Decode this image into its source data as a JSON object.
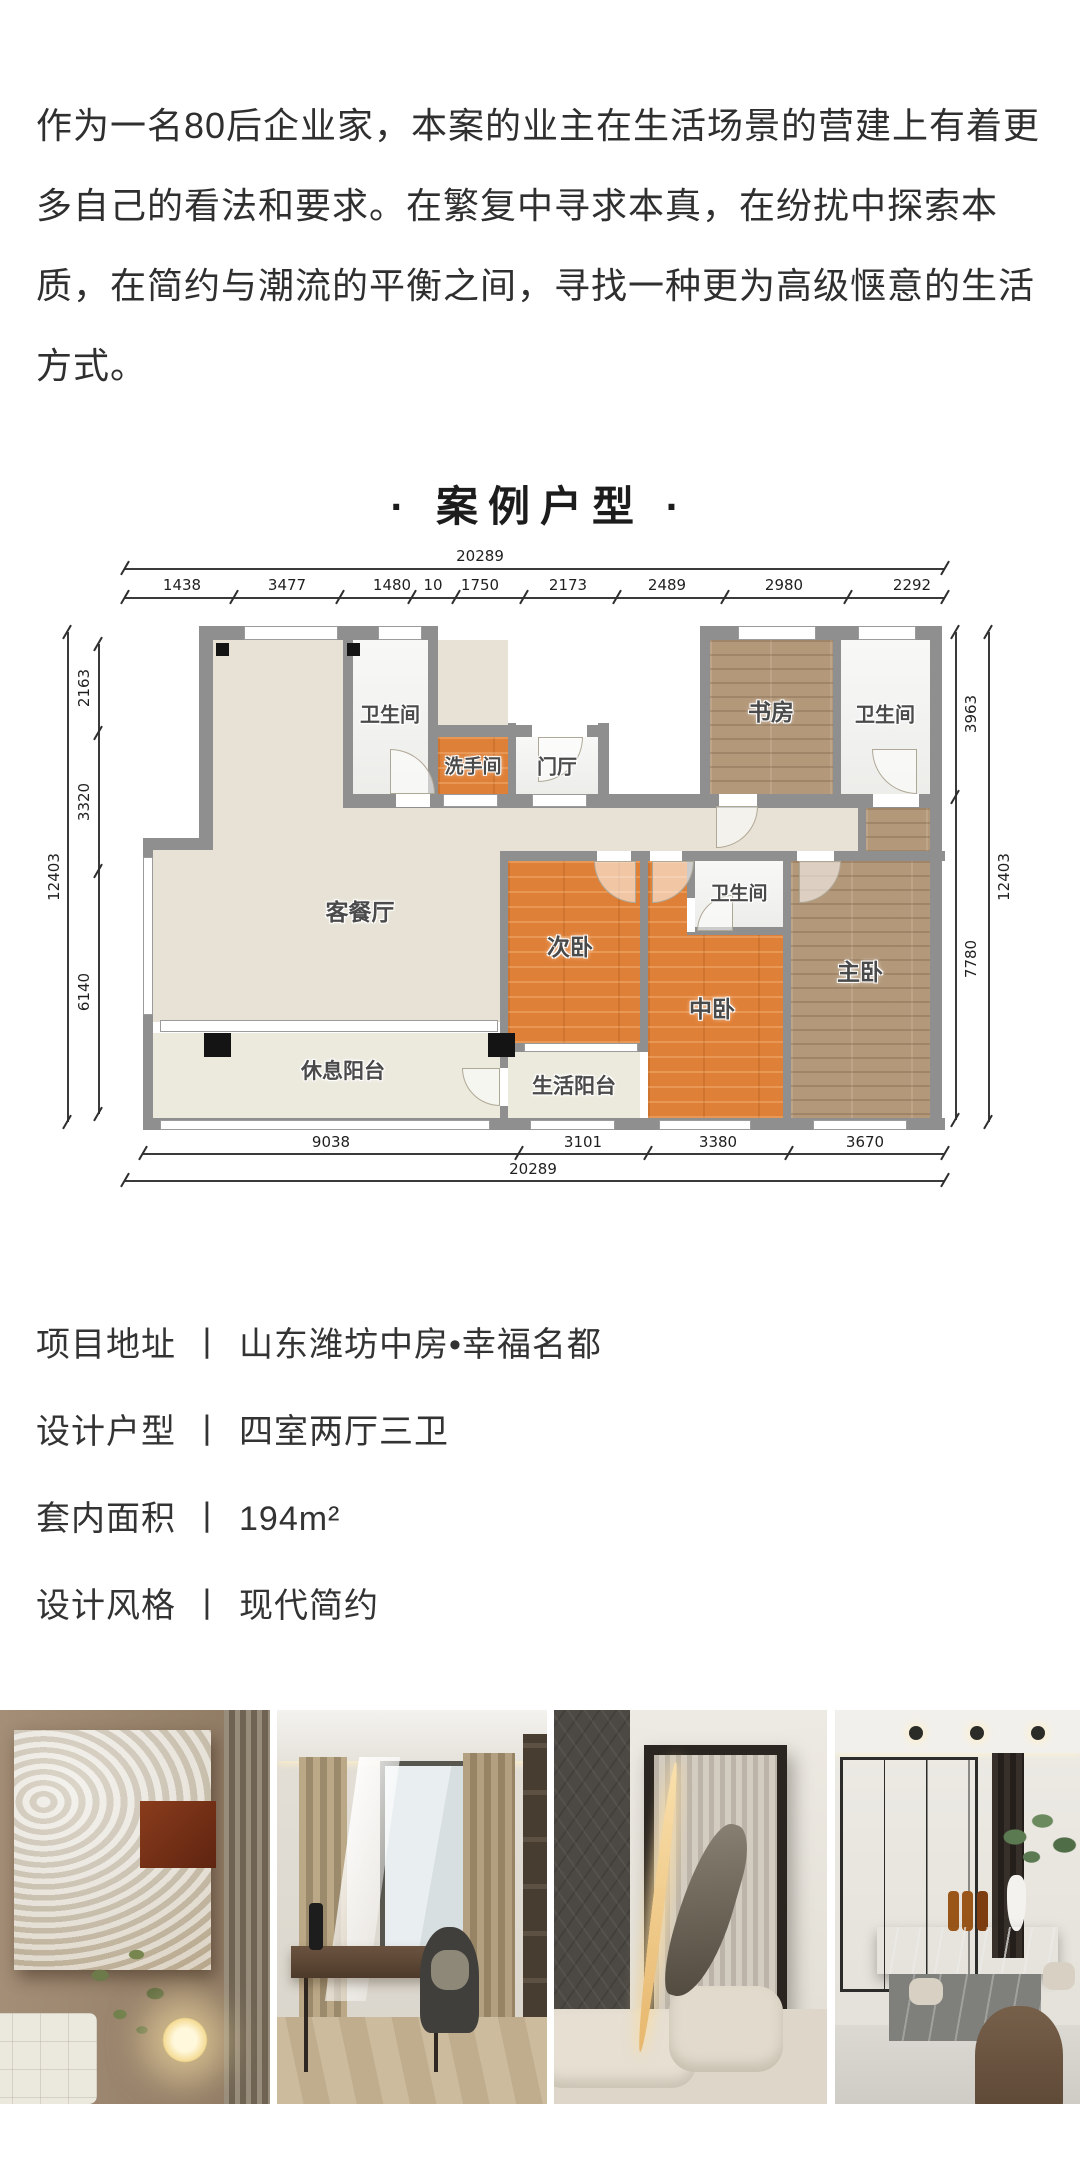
{
  "intro": {
    "text": "作为一名80后企业家，本案的业主在生活场景的营建上有着更多自己的看法和要求。在繁复中寻求本真，在纷扰中探索本质，在简约与潮流的平衡之间，寻找一种更为高级惬意的生活方式。"
  },
  "section_title": {
    "text": "· 案例户型 ·"
  },
  "project_info": {
    "items": [
      {
        "label": "项目地址",
        "sep": "丨",
        "value": "山东潍坊中房•幸福名都"
      },
      {
        "label": "设计户型",
        "sep": "丨",
        "value": "四室两厅三卫"
      },
      {
        "label": "套内面积",
        "sep": "丨",
        "value": "194m²"
      },
      {
        "label": "设计风格",
        "sep": "丨",
        "value": "现代简约"
      }
    ]
  },
  "photos": [
    {
      "name": "photo-bedroom-artwork"
    },
    {
      "name": "photo-study-room"
    },
    {
      "name": "photo-living-room-artwork"
    },
    {
      "name": "photo-dining-bar"
    }
  ],
  "floorplan": {
    "wall_color": "#8f8f8f",
    "accent_orange": "#df8038",
    "accent_wood": "#b3987a",
    "areas": [
      {
        "n": "living-dining",
        "f": "beige",
        "x": 153,
        "y": 85,
        "w": 295,
        "h": 382
      },
      {
        "n": "living-bay",
        "f": "beige",
        "x": 93,
        "y": 295,
        "w": 60,
        "h": 172
      },
      {
        "n": "corridor",
        "f": "beige",
        "x": 448,
        "y": 253,
        "w": 350,
        "h": 43
      },
      {
        "n": "bathroom-1",
        "f": "tile",
        "x": 293,
        "y": 85,
        "w": 75,
        "h": 154
      },
      {
        "n": "washroom",
        "f": "orange",
        "x": 378,
        "y": 182,
        "w": 70,
        "h": 57
      },
      {
        "n": "entry-hall",
        "f": "tile",
        "x": 456,
        "y": 182,
        "w": 82,
        "h": 57
      },
      {
        "n": "study",
        "f": "wood",
        "x": 650,
        "y": 85,
        "w": 123,
        "h": 155
      },
      {
        "n": "bathroom-2",
        "f": "tile",
        "x": 781,
        "y": 85,
        "w": 89,
        "h": 155
      },
      {
        "n": "master-bedroom-upper",
        "f": "wood",
        "x": 806,
        "y": 253,
        "w": 64,
        "h": 49
      },
      {
        "n": "second-bedroom",
        "f": "orange",
        "x": 448,
        "y": 306,
        "w": 132,
        "h": 182
      },
      {
        "n": "middle-bedroom",
        "f": "orange",
        "x": 588,
        "y": 306,
        "w": 135,
        "h": 259
      },
      {
        "n": "master-bedroom",
        "f": "wood",
        "x": 731,
        "y": 306,
        "w": 139,
        "h": 259
      },
      {
        "n": "bathroom-3",
        "f": "tile",
        "x": 635,
        "y": 306,
        "w": 88,
        "h": 66
      },
      {
        "n": "utility-balcony",
        "f": "balcony",
        "x": 448,
        "y": 497,
        "w": 132,
        "h": 68
      },
      {
        "n": "rest-balcony",
        "f": "balcony",
        "x": 93,
        "y": 478,
        "w": 347,
        "h": 85
      }
    ],
    "walls": [
      [
        139,
        71,
        239,
        14
      ],
      [
        640,
        71,
        240,
        14
      ],
      [
        368,
        170,
        181,
        12
      ],
      [
        139,
        71,
        14,
        224
      ],
      [
        83,
        283,
        70,
        12
      ],
      [
        83,
        283,
        10,
        292
      ],
      [
        83,
        563,
        802,
        12
      ],
      [
        870,
        71,
        12,
        504
      ],
      [
        368,
        71,
        10,
        172
      ],
      [
        640,
        71,
        10,
        182
      ],
      [
        283,
        71,
        10,
        180
      ],
      [
        283,
        239,
        597,
        14
      ],
      [
        448,
        168,
        8,
        83
      ],
      [
        538,
        168,
        11,
        85
      ],
      [
        773,
        71,
        8,
        182
      ],
      [
        798,
        240,
        8,
        62
      ],
      [
        448,
        296,
        437,
        10
      ],
      [
        440,
        296,
        8,
        279
      ],
      [
        580,
        296,
        8,
        200
      ],
      [
        448,
        488,
        140,
        9
      ],
      [
        723,
        296,
        8,
        279
      ],
      [
        627,
        296,
        8,
        84
      ],
      [
        627,
        372,
        104,
        8
      ]
    ],
    "windows": [
      [
        184,
        71,
        94,
        14
      ],
      [
        318,
        71,
        44,
        14
      ],
      [
        678,
        71,
        78,
        14
      ],
      [
        798,
        71,
        58,
        14
      ],
      [
        83,
        302,
        10,
        158
      ],
      [
        100,
        465,
        338,
        12
      ],
      [
        100,
        565,
        330,
        10
      ],
      [
        470,
        565,
        85,
        10
      ],
      [
        599,
        565,
        92,
        10
      ],
      [
        753,
        565,
        94,
        10
      ],
      [
        464,
        488,
        114,
        9
      ],
      [
        383,
        239,
        55,
        13
      ],
      [
        472,
        239,
        55,
        13
      ]
    ],
    "gaps": [
      [
        336,
        239,
        34,
        13
      ],
      [
        472,
        170,
        55,
        12
      ],
      [
        659,
        239,
        38,
        13
      ],
      [
        813,
        239,
        46,
        13
      ],
      [
        537,
        296,
        34,
        10
      ],
      [
        590,
        296,
        32,
        10
      ],
      [
        737,
        296,
        37,
        10
      ],
      [
        627,
        343,
        8,
        34
      ],
      [
        440,
        513,
        8,
        38
      ]
    ],
    "columns": [
      [
        156,
        88,
        13,
        13
      ],
      [
        287,
        88,
        13,
        13
      ],
      [
        144,
        478,
        27,
        24
      ],
      [
        428,
        478,
        27,
        24
      ]
    ],
    "doors": [
      [
        330,
        194,
        45,
        270
      ],
      [
        478,
        182,
        45,
        0
      ],
      [
        656,
        251,
        42,
        0
      ],
      [
        812,
        194,
        45,
        90
      ],
      [
        534,
        306,
        42,
        90
      ],
      [
        592,
        306,
        42,
        0
      ],
      [
        739,
        306,
        42,
        0
      ],
      [
        637,
        340,
        36,
        180
      ],
      [
        402,
        513,
        38,
        90
      ]
    ],
    "labels": [
      {
        "t": "客餐厅",
        "x": 300,
        "y": 355,
        "s": 23
      },
      {
        "t": "卫生间",
        "x": 330,
        "y": 158,
        "s": 20
      },
      {
        "t": "洗手间",
        "x": 413,
        "y": 210,
        "s": 19
      },
      {
        "t": "门厅",
        "x": 497,
        "y": 210,
        "s": 20
      },
      {
        "t": "书房",
        "x": 711,
        "y": 155,
        "s": 23
      },
      {
        "t": "卫生间",
        "x": 825,
        "y": 158,
        "s": 20
      },
      {
        "t": "卫生间",
        "x": 679,
        "y": 337,
        "s": 19
      },
      {
        "t": "次卧",
        "x": 510,
        "y": 390,
        "s": 23
      },
      {
        "t": "中卧",
        "x": 652,
        "y": 452,
        "s": 23
      },
      {
        "t": "主卧",
        "x": 800,
        "y": 415,
        "s": 23
      },
      {
        "t": "生活阳台",
        "x": 514,
        "y": 530,
        "s": 21
      },
      {
        "t": "休息阳台",
        "x": 283,
        "y": 515,
        "s": 21
      }
    ],
    "dims": [
      {
        "x1": 65,
        "y1": 13,
        "x2": 885,
        "y2": 13,
        "ticks": [
          [
            65,
            13
          ],
          [
            885,
            13
          ]
        ],
        "labels": [
          {
            "t": "20289",
            "x": 420,
            "y": 1
          }
        ]
      },
      {
        "x1": 65,
        "y1": 42,
        "x2": 885,
        "y2": 42,
        "ticks": [
          [
            65,
            42
          ],
          [
            174,
            42
          ],
          [
            280,
            42
          ],
          [
            352,
            42
          ],
          [
            396,
            42
          ],
          [
            464,
            42
          ],
          [
            557,
            42
          ],
          [
            665,
            42
          ],
          [
            788,
            42
          ],
          [
            885,
            42
          ]
        ],
        "labels": [
          {
            "t": "1438",
            "x": 122,
            "y": 30
          },
          {
            "t": "3477",
            "x": 227,
            "y": 30
          },
          {
            "t": "1480",
            "x": 332,
            "y": 30
          },
          {
            "t": "10",
            "x": 373,
            "y": 30
          },
          {
            "t": "1750",
            "x": 420,
            "y": 30
          },
          {
            "t": "2173",
            "x": 508,
            "y": 30
          },
          {
            "t": "2489",
            "x": 607,
            "y": 30
          },
          {
            "t": "2980",
            "x": 724,
            "y": 30
          },
          {
            "t": "2292",
            "x": 852,
            "y": 30
          }
        ]
      },
      {
        "x1": 7,
        "y1": 77,
        "x2": 7,
        "y2": 567,
        "ticks": [
          [
            7,
            77
          ],
          [
            7,
            567
          ]
        ],
        "labels": [
          {
            "t": "12403",
            "x": -6,
            "y": 322,
            "r": -90
          }
        ]
      },
      {
        "x1": 38,
        "y1": 89,
        "x2": 38,
        "y2": 559,
        "ticks": [
          [
            38,
            89
          ],
          [
            38,
            178
          ],
          [
            38,
            316
          ],
          [
            38,
            559
          ]
        ],
        "labels": [
          {
            "t": "2163",
            "x": 24,
            "y": 133,
            "r": -90
          },
          {
            "t": "3320",
            "x": 24,
            "y": 247,
            "r": -90
          },
          {
            "t": "6140",
            "x": 24,
            "y": 437,
            "r": -90
          }
        ]
      },
      {
        "x1": 895,
        "y1": 77,
        "x2": 895,
        "y2": 565,
        "ticks": [
          [
            895,
            77
          ],
          [
            895,
            242
          ],
          [
            895,
            565
          ]
        ],
        "labels": [
          {
            "t": "3963",
            "x": 911,
            "y": 159,
            "r": -90
          },
          {
            "t": "7780",
            "x": 911,
            "y": 404,
            "r": -90
          }
        ]
      },
      {
        "x1": 928,
        "y1": 77,
        "x2": 928,
        "y2": 567,
        "ticks": [
          [
            928,
            77
          ],
          [
            928,
            567
          ]
        ],
        "labels": [
          {
            "t": "12403",
            "x": 944,
            "y": 322,
            "r": -90
          }
        ]
      },
      {
        "x1": 83,
        "y1": 598,
        "x2": 885,
        "y2": 598,
        "ticks": [
          [
            83,
            598
          ],
          [
            459,
            598
          ],
          [
            588,
            598
          ],
          [
            729,
            598
          ],
          [
            885,
            598
          ]
        ],
        "labels": [
          {
            "t": "9038",
            "x": 271,
            "y": 587
          },
          {
            "t": "3101",
            "x": 523,
            "y": 587
          },
          {
            "t": "3380",
            "x": 658,
            "y": 587
          },
          {
            "t": "3670",
            "x": 805,
            "y": 587
          }
        ]
      },
      {
        "x1": 65,
        "y1": 625,
        "x2": 885,
        "y2": 625,
        "ticks": [
          [
            65,
            625
          ],
          [
            885,
            625
          ]
        ],
        "labels": [
          {
            "t": "20289",
            "x": 473,
            "y": 614
          }
        ]
      }
    ]
  }
}
